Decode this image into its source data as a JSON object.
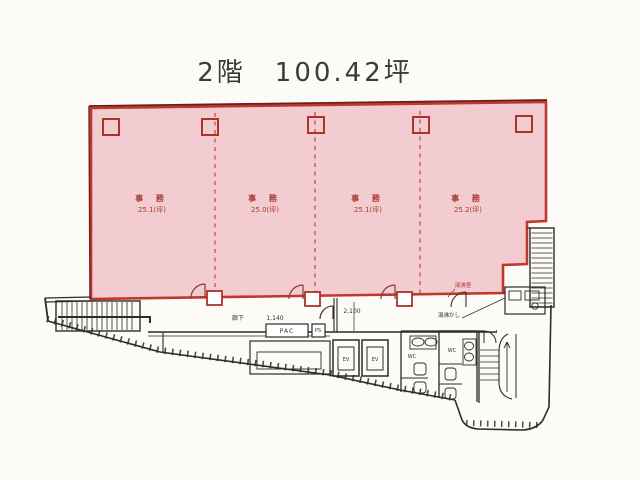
{
  "title": "2階　100.42坪",
  "colors": {
    "area_fill": "#f3ccd1",
    "area_border": "#bf382e",
    "label_red": "#a83a2e",
    "line_black": "#2e2b27"
  },
  "tenant": {
    "bays": [
      {
        "name": "事 務",
        "area": "25.1(坪)"
      },
      {
        "name": "事 務",
        "area": "25.0(坪)"
      },
      {
        "name": "事 務",
        "area": "25.1(坪)"
      },
      {
        "name": "事 務",
        "area": "25.2(坪)"
      }
    ],
    "kitchenette": "湯沸室"
  },
  "common": {
    "corridor": "廊下",
    "corridor_width": "1,140",
    "hall_width": "2,100",
    "kitchenette_note": "湯沸かし",
    "pac": "PAC",
    "ps": "PS",
    "ev": "EV",
    "wc_men": "WC",
    "wc_women": "WC"
  }
}
